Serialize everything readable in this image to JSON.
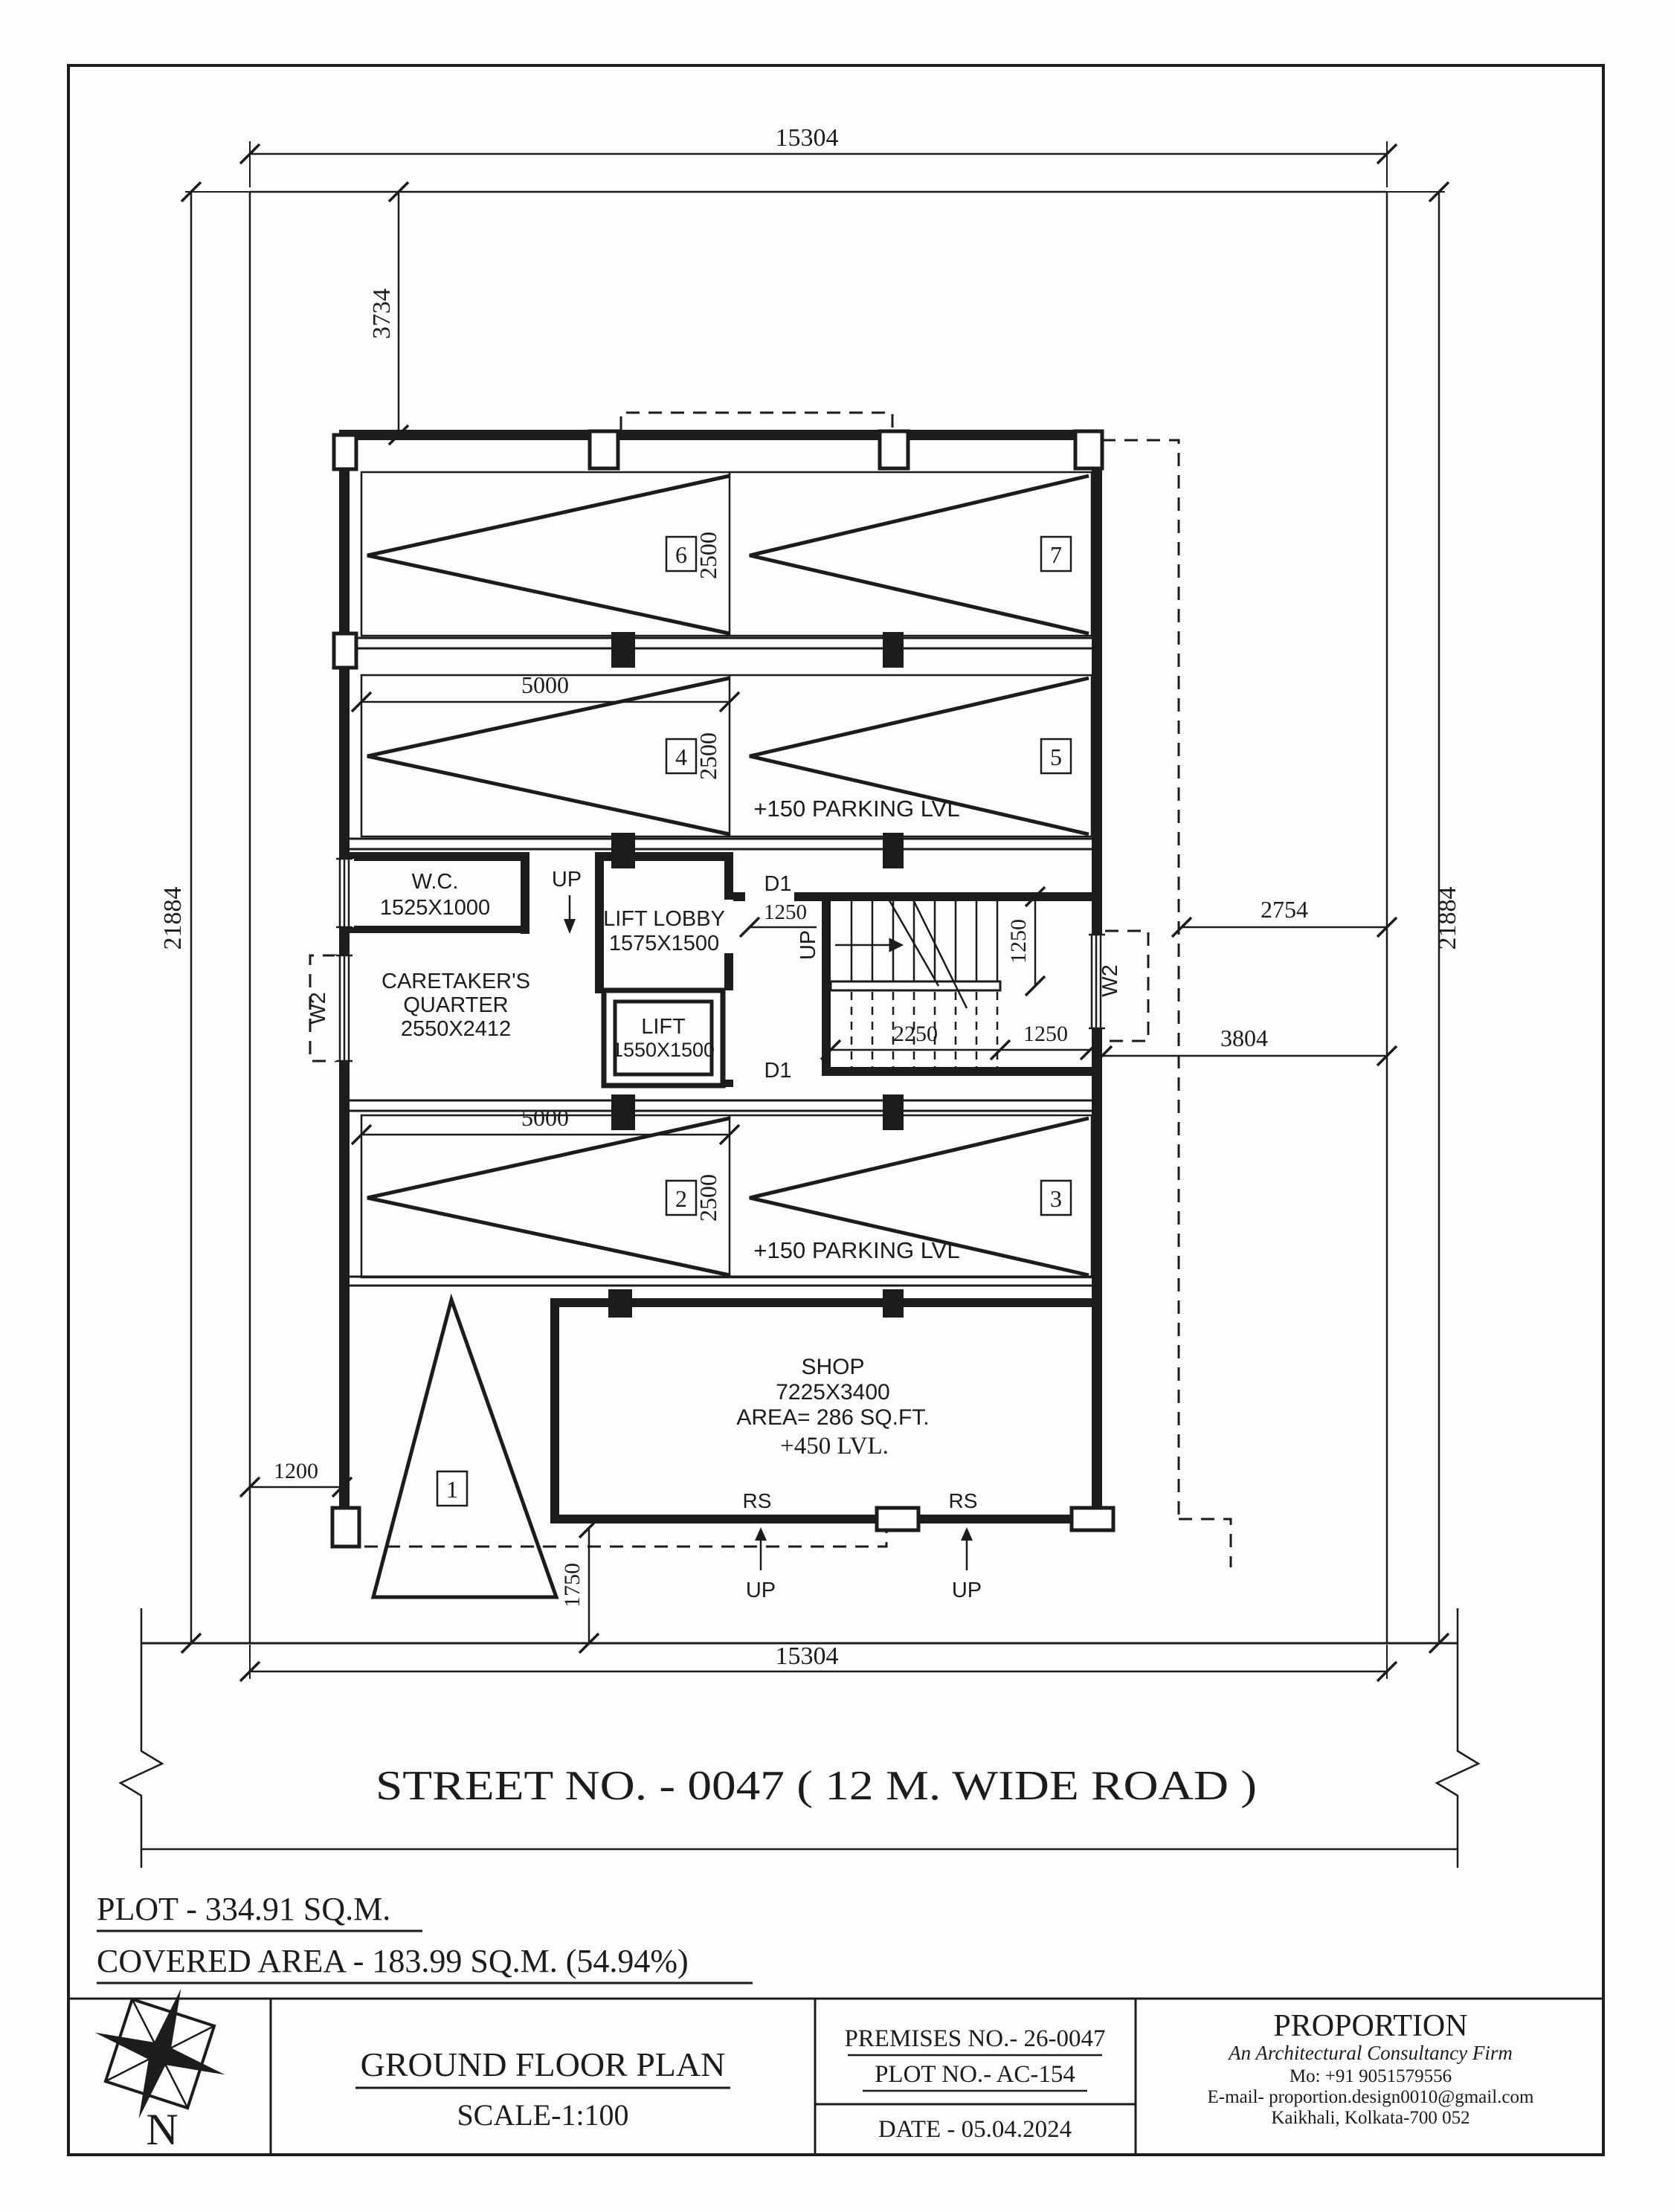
{
  "colors": {
    "ink": "#1c1c1c",
    "paper": "#fdfdfd"
  },
  "plan": {
    "dims": {
      "width_top": "15304",
      "width_bottom": "15304",
      "height_left": "21884",
      "height_right": "21884",
      "setback_top": "3734",
      "stall_depth": "2500",
      "stall_pair_width": "5000",
      "right_upper": "2754",
      "right_lower": "3804",
      "lobby_door": "1250",
      "stair_flight": "1250",
      "stair_run": "2250",
      "stair_landing": "1250",
      "setback_left": "1200",
      "setback_front": "1750"
    },
    "rooms": {
      "wc_name": "W.C.",
      "wc_size": "1525X1000",
      "caretaker_line1": "CARETAKER'S",
      "caretaker_line2": "QUARTER",
      "caretaker_size": "2550X2412",
      "lift_lobby_name": "LIFT LOBBY",
      "lift_lobby_size": "1575X1500",
      "lift_name": "LIFT",
      "lift_size": "1550X1500",
      "shop_name": "SHOP",
      "shop_size": "7225X3400",
      "shop_area": "AREA= 286 SQ.FT.",
      "shop_level": "+450 LVL."
    },
    "labels": {
      "parking_level": "+150 PARKING LVL",
      "up": "UP",
      "rs": "RS",
      "d1": "D1",
      "w2": "W2",
      "stall_1": "1",
      "stall_2": "2",
      "stall_3": "3",
      "stall_4": "4",
      "stall_5": "5",
      "stall_6": "6",
      "stall_7": "7"
    },
    "street_label": "STREET  NO. - 0047   ( 12 M.  WIDE  ROAD )"
  },
  "footer": {
    "plot": "PLOT - 334.91 SQ.M.",
    "covered": "COVERED AREA - 183.99 SQ.M. (54.94%)"
  },
  "titleblock": {
    "north": "N",
    "title": "GROUND FLOOR PLAN",
    "scale": "SCALE-1:100",
    "premises": "PREMISES NO.- 26-0047",
    "plot_no": "PLOT NO.- AC-154",
    "date": "DATE - 05.04.2024",
    "firm": "PROPORTION",
    "tagline": "An Architectural Consultancy Firm",
    "mobile": "Mo: +91 9051579556",
    "email": "E-mail- proportion.design0010@gmail.com",
    "address": "Kaikhali, Kolkata-700 052"
  }
}
